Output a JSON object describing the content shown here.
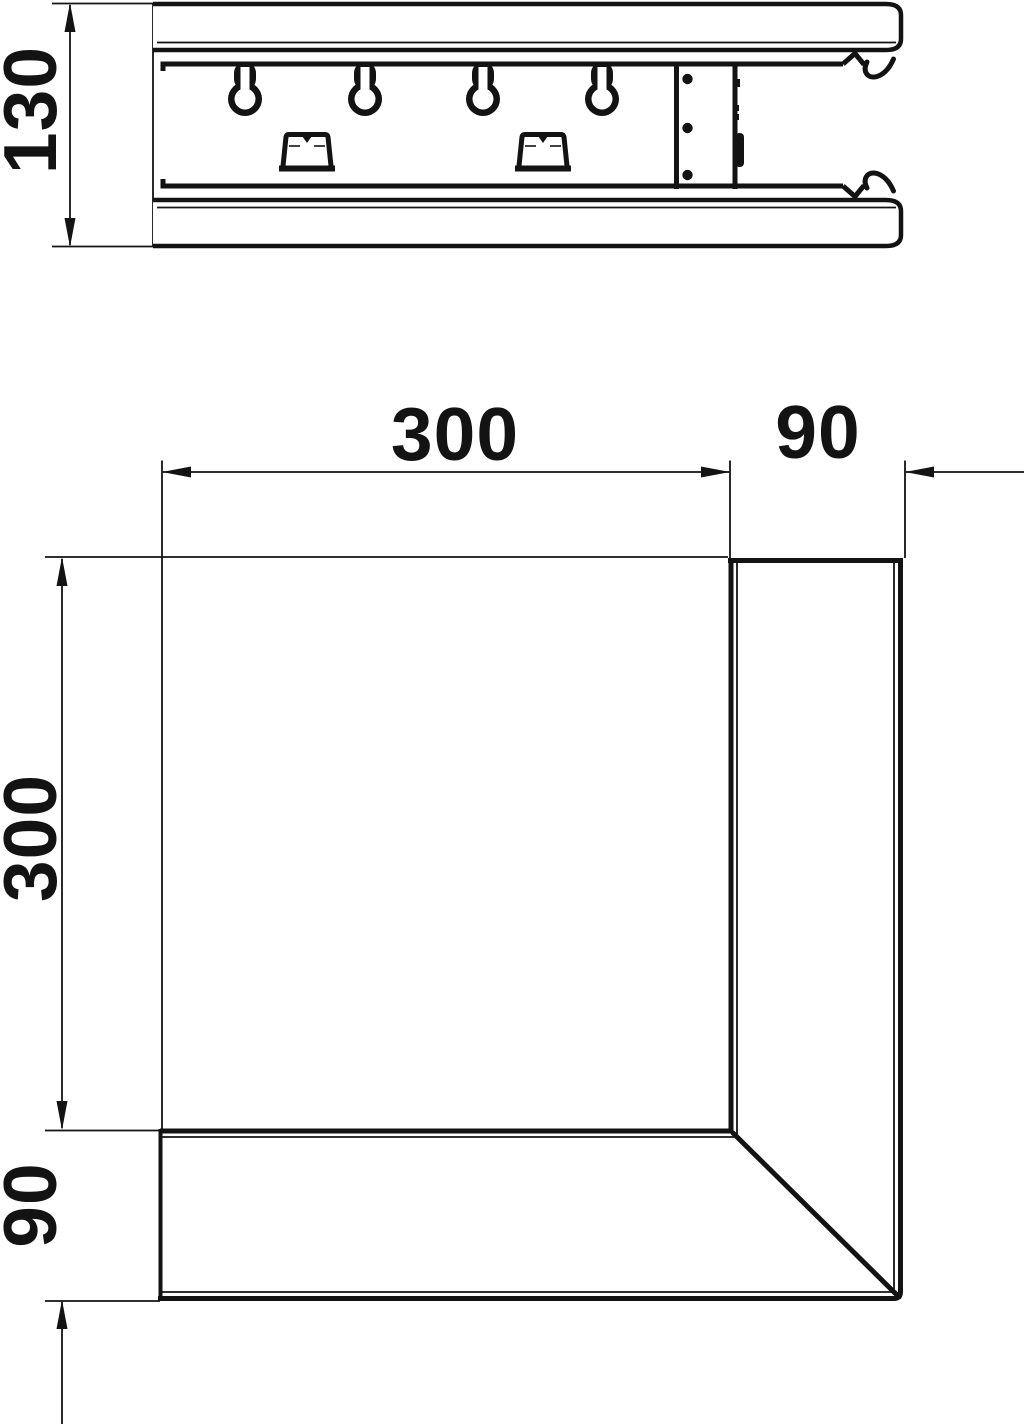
{
  "drawing": {
    "colors": {
      "line": "#131313",
      "background": "#ffffff"
    },
    "side_view": {
      "height_dimension": "130"
    },
    "plan_view": {
      "width_dimension": "300",
      "duct_width_top_dimension": "90",
      "height_dimension": "300",
      "duct_width_left_dimension": "90"
    }
  }
}
